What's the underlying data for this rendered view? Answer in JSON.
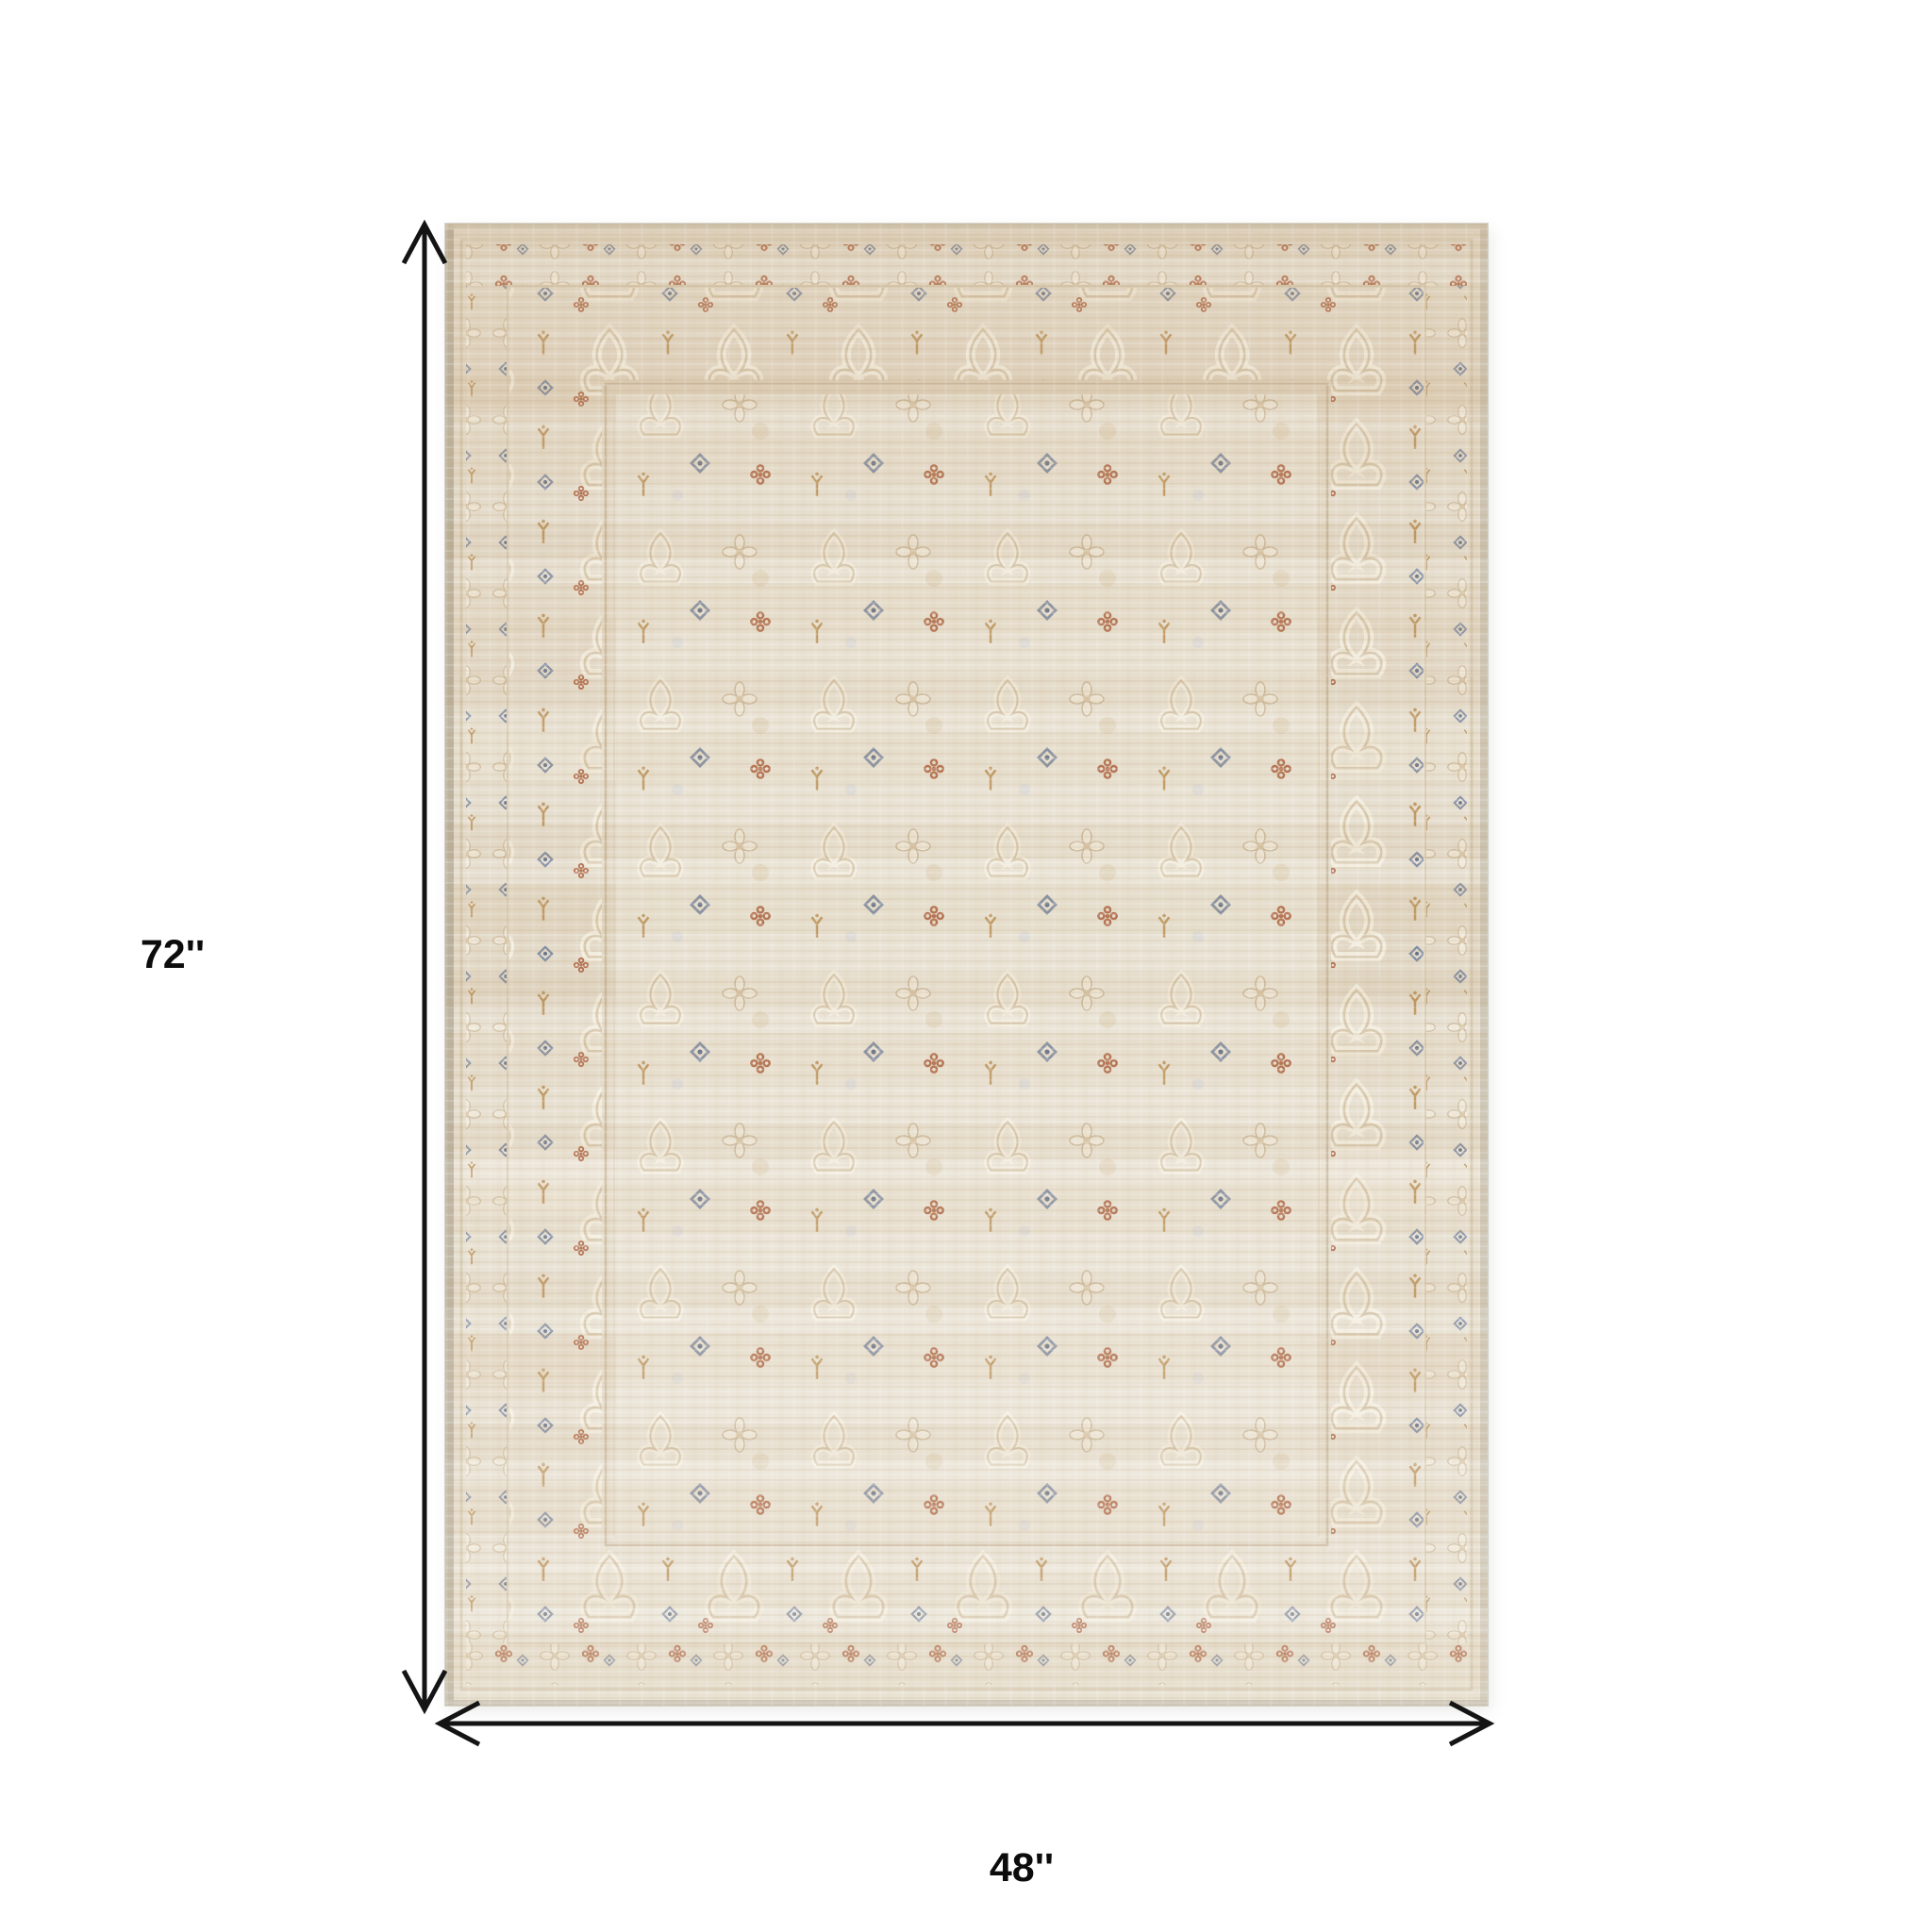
{
  "page": {
    "background_color": "#ffffff"
  },
  "diagram": {
    "subject": "Distressed vintage oriental area rug, ivory and beige field with rust, gold and slate-blue floral motifs and bordered edge",
    "rug_colors": {
      "base": "#e5ddcd",
      "ivory_motif": "#f2ecdd",
      "tan_band": "#d8c6aa",
      "rust": "#ad6443",
      "slate_blue": "#7b88a0",
      "gold": "#bb9157",
      "edge_selvage": "#b1a793"
    },
    "arrow_color": "#141414",
    "label_color": "#0c0c0c"
  },
  "dimensions": {
    "height": {
      "label": "72''"
    },
    "width": {
      "label": "48''"
    }
  },
  "icons": {
    "height_arrow": "double-headed-vertical-arrow",
    "width_arrow": "double-headed-horizontal-arrow"
  }
}
